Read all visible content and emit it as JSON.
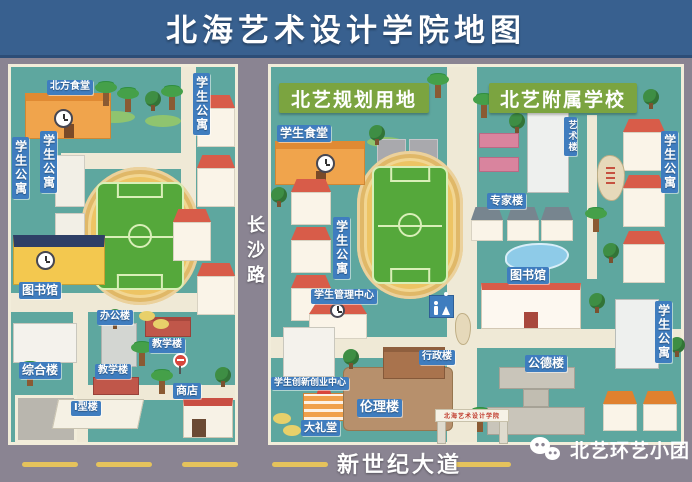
{
  "title": "北海艺术设计学院地图",
  "roads": {
    "changsha": "长沙路",
    "new_century": "新世纪大道"
  },
  "watermark": {
    "label": "北艺环艺小团"
  },
  "left": {
    "north_canteen": "北方食堂",
    "dorm_a": "学生公寓",
    "dorm_b": "学生公寓",
    "dorm_c": "学生公寓",
    "library": "图书馆",
    "office": "办公楼",
    "teaching_a": "教学楼",
    "teaching_b": "教学楼",
    "complex": "综合楼",
    "type_i": "I型楼",
    "shop": "商店"
  },
  "right": {
    "planned": {
      "banner": "北艺规划用地",
      "canteen": "学生食堂",
      "dorm": "学生公寓",
      "mgmt": "学生管理中心",
      "innovation": "学生创新创业中心",
      "auditorium": "大礼堂",
      "ethics": "伦理楼",
      "admin": "行政楼"
    },
    "affiliated": {
      "banner": "北艺附属学校",
      "art": "艺术楼",
      "expert": "专家楼",
      "library": "图书馆",
      "morality": "公德楼",
      "dorm_top": "学生公寓",
      "dorm_mid": "学生公寓",
      "gate": "北海艺术设计学院"
    }
  },
  "colors": {
    "title_bar": "#38608f",
    "panel_teal": "#5ea79f",
    "road_gray": "#8a8492",
    "path_cream": "#efe9d6",
    "banner_green": "#7ba440",
    "label_blue": "#3f7dbf",
    "track_orange": "#edc464",
    "field_green": "#55a83b",
    "dash_yellow": "#e5c35c"
  },
  "icons": {
    "clock": "css-circle-clock",
    "restroom": "male-female-figures",
    "wechat": "double-chat-bubbles",
    "palm": "css-palm",
    "tree": "css-tree",
    "stop_sign": "red-circle-sign",
    "inscribed_stone": "rock-with-red-calligraphy"
  }
}
